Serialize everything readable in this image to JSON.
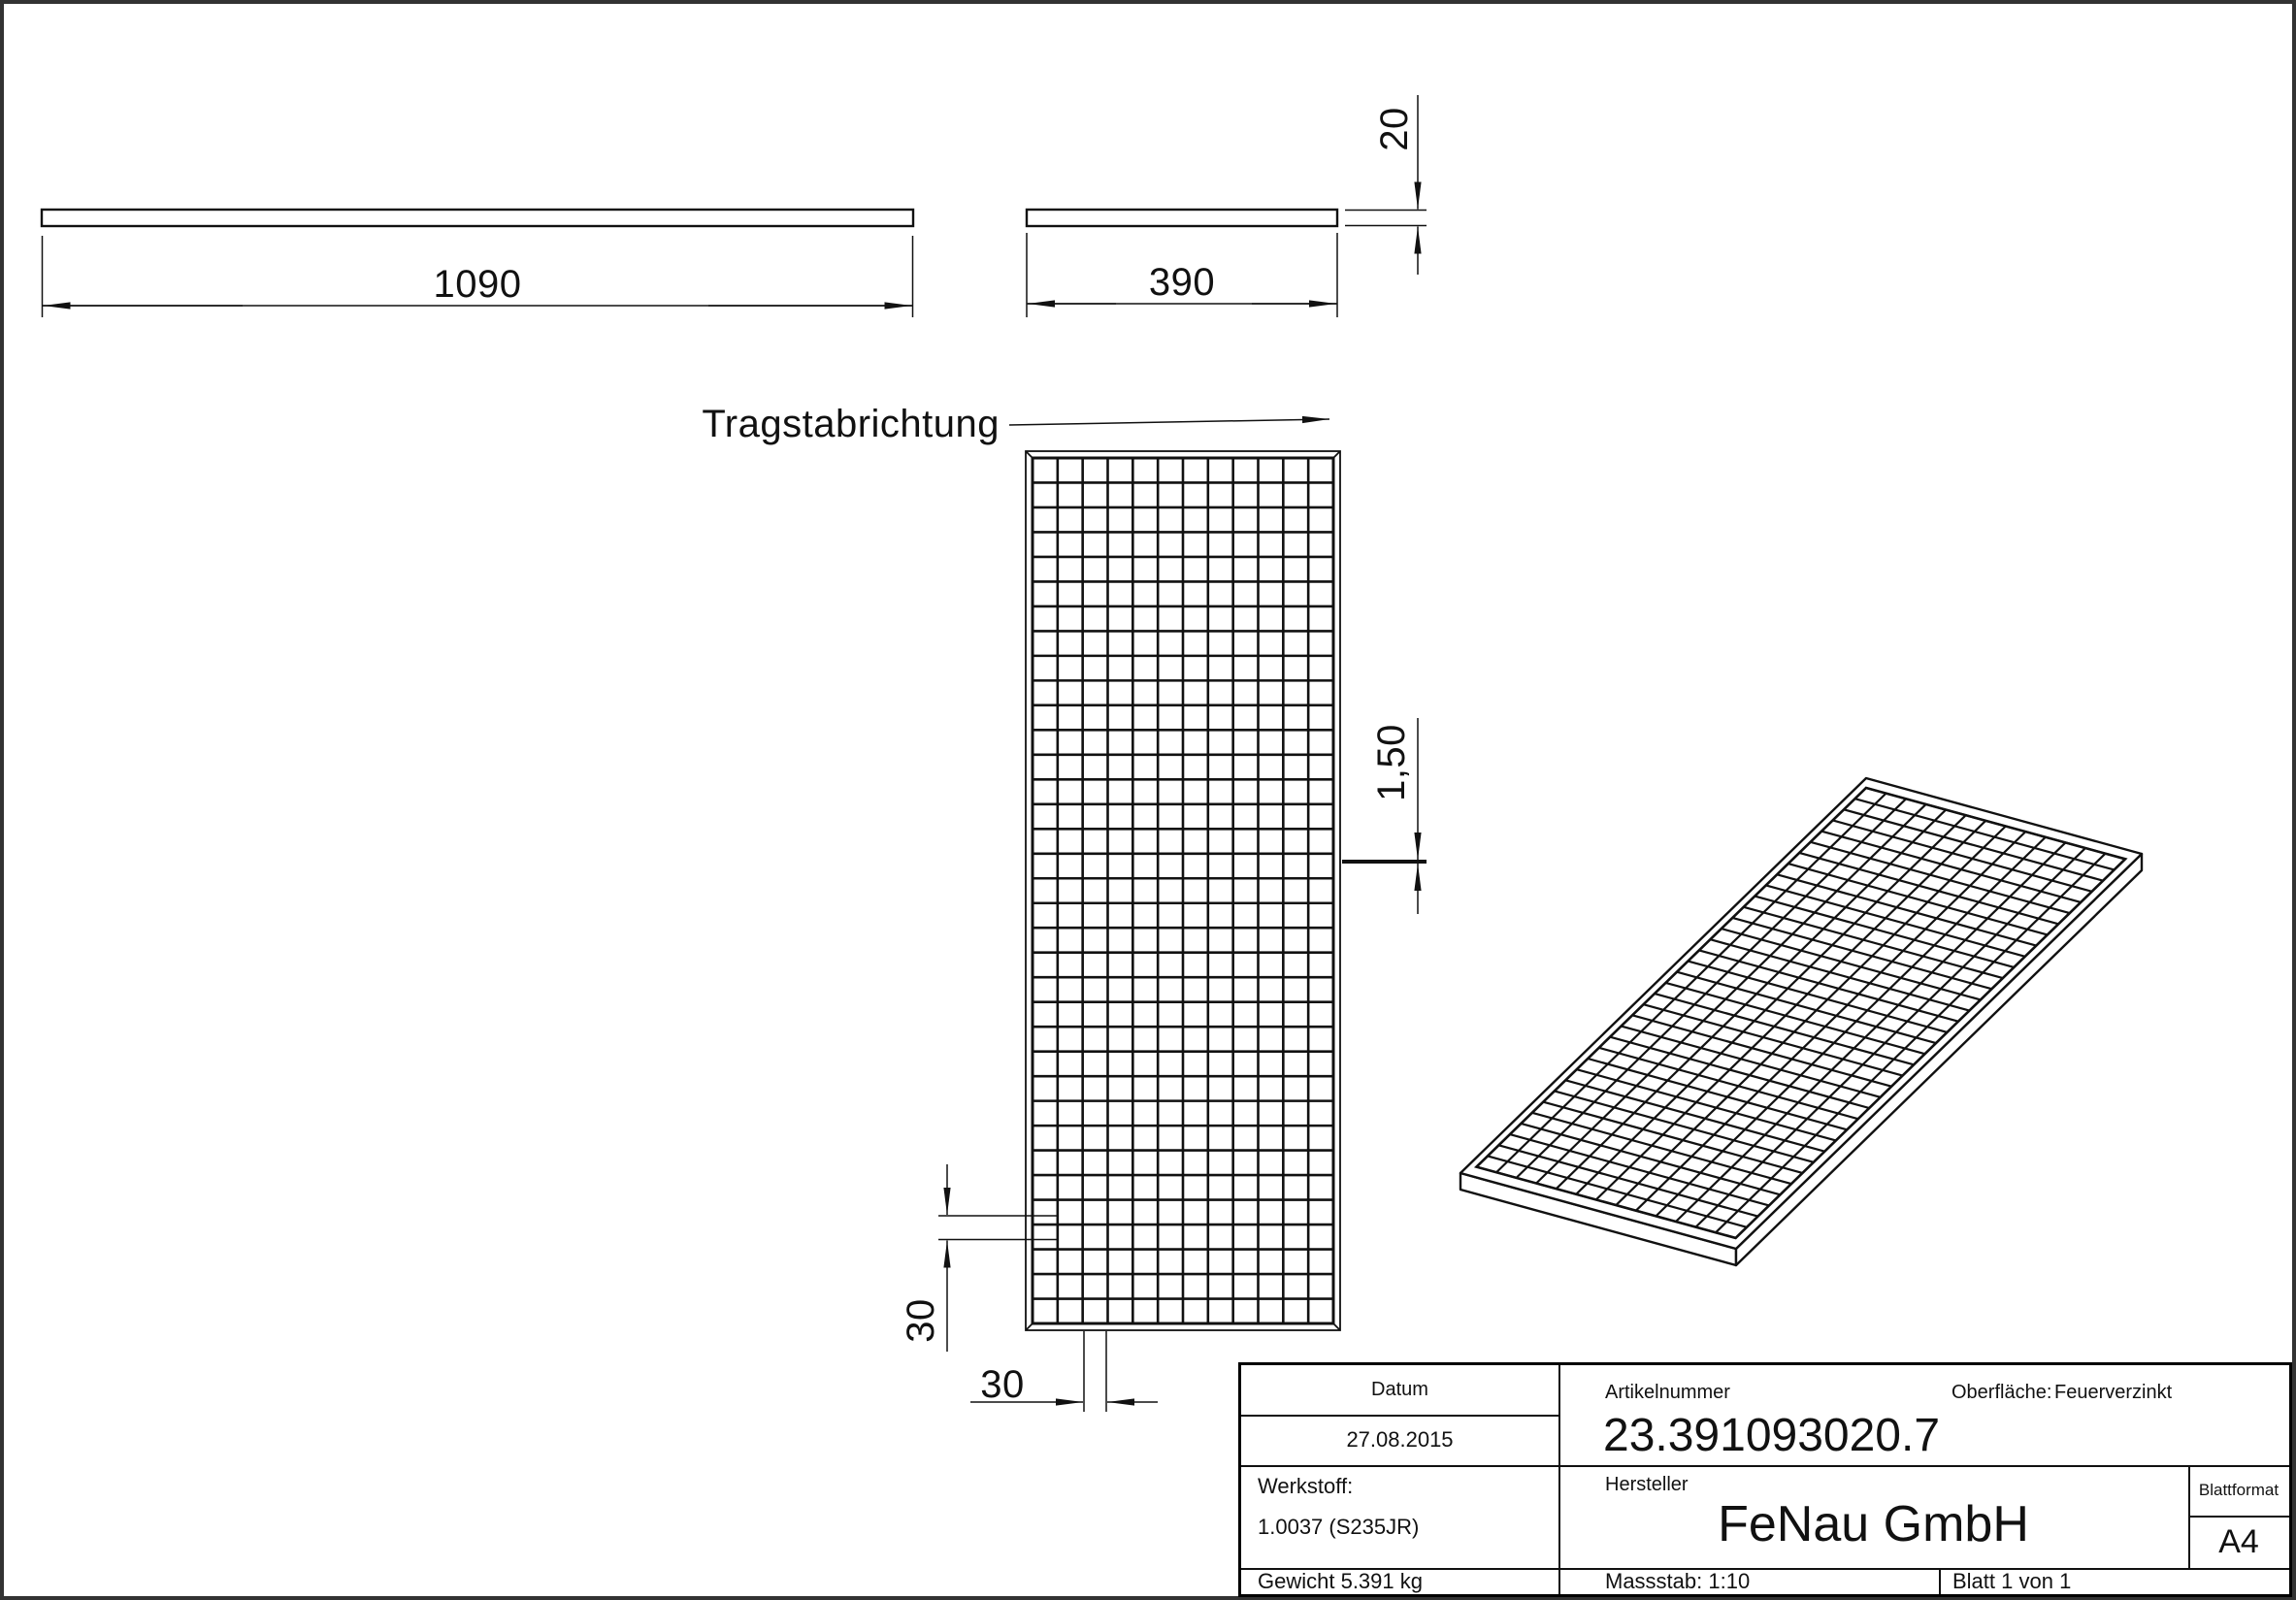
{
  "colors": {
    "line": "#111111",
    "frame": "#333333",
    "background": "#ffffff"
  },
  "views": {
    "side_long": {
      "length_dim": "1090"
    },
    "side_short": {
      "width_dim": "390",
      "height_dim": "20"
    },
    "front": {
      "direction_label": "Tragstabrichtung",
      "bearing_bar_thickness_dim": "1,50",
      "mesh_pitch_vertical_dim": "30",
      "mesh_pitch_horizontal_dim": "30",
      "mesh_cols": 12,
      "mesh_rows": 35
    },
    "iso": {
      "mesh_cols": 13,
      "mesh_rows": 35
    }
  },
  "title_block": {
    "datum_label": "Datum",
    "datum_value": "27.08.2015",
    "artikelnummer_label": "Artikelnummer",
    "artikelnummer_value": "23.391093020.7",
    "oberflaeche_label": "Oberfläche:",
    "oberflaeche_value": "Feuerverzinkt",
    "werkstoff_label": "Werkstoff:",
    "werkstoff_value": "1.0037 (S235JR)",
    "hersteller_label": "Hersteller",
    "hersteller_value": "FeNau GmbH",
    "blattformat_label": "Blattformat",
    "blattformat_value": "A4",
    "gewicht_value": "Gewicht 5.391 kg",
    "massstab_value": "Massstab: 1:10",
    "blatt_value": "Blatt 1 von 1"
  }
}
